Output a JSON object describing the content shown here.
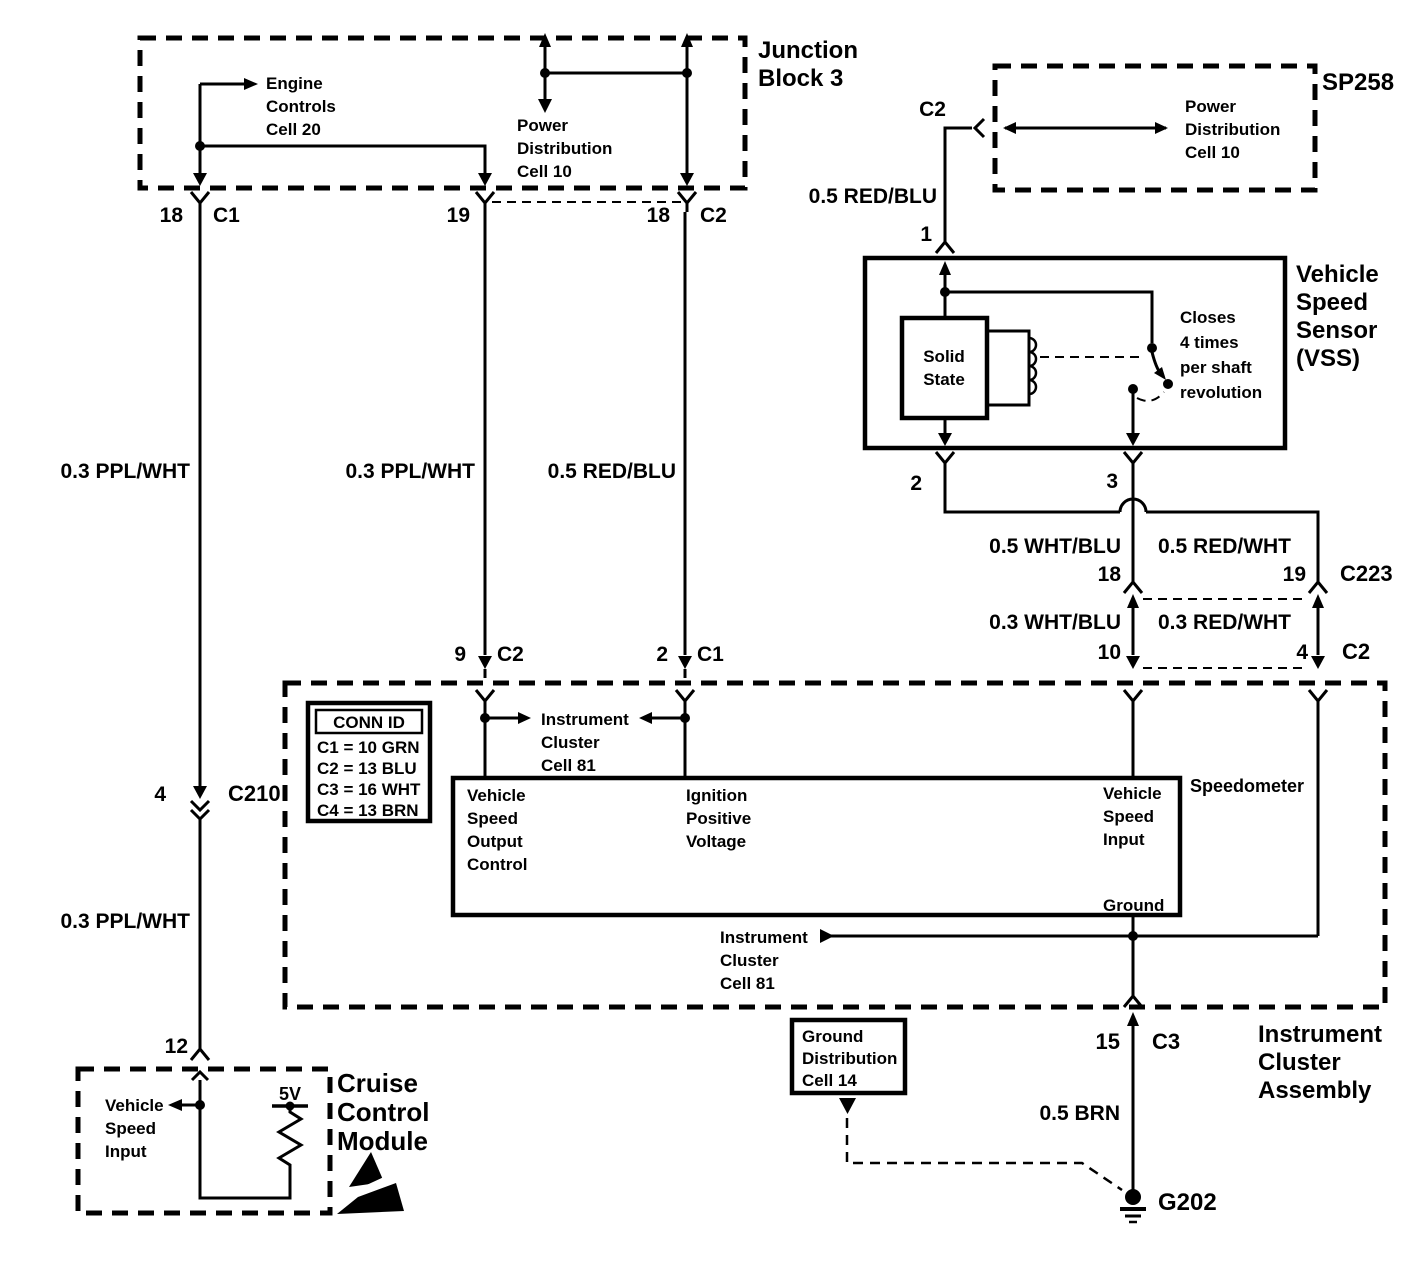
{
  "colors": {
    "ink": "#000000",
    "background": "#ffffff"
  },
  "junction_block": {
    "title": [
      "Junction",
      "Block 3"
    ],
    "engine_controls_ref": [
      "Engine",
      "Controls",
      "Cell 20"
    ],
    "power_distribution_ref": [
      "Power",
      "Distribution",
      "Cell 10"
    ],
    "pin_18_left": "18",
    "conn_c1": "C1",
    "pin_19": "19",
    "pin_18_right": "18",
    "conn_c2": "C2"
  },
  "sp258": {
    "title": "SP258",
    "conn_c2": "C2",
    "power_distribution_ref": [
      "Power",
      "Distribution",
      "Cell 10"
    ],
    "wire_label": "0.5 RED/BLU",
    "pin_1": "1"
  },
  "vss": {
    "title": [
      "Vehicle",
      "Speed",
      "Sensor",
      "(VSS)"
    ],
    "solid_state": [
      "Solid",
      "State"
    ],
    "closes_note": [
      "Closes",
      "4 times",
      "per shaft",
      "revolution"
    ],
    "pin_2": "2",
    "pin_3": "3"
  },
  "right_wires": {
    "wht_blu_05": "0.5 WHT/BLU",
    "red_wht_05": "0.5 RED/WHT",
    "pin_18": "18",
    "pin_19": "19",
    "conn_c223": "C223",
    "wht_blu_03": "0.3 WHT/BLU",
    "red_wht_03": "0.3 RED/WHT",
    "pin_10": "10",
    "pin_4": "4",
    "conn_c2": "C2"
  },
  "left_wires": {
    "ppl_wht_upper": "0.3 PPL/WHT",
    "ppl_wht_mid": "0.3 PPL/WHT",
    "red_blu_mid": "0.5 RED/BLU",
    "pin_4": "4",
    "conn_c210": "C210",
    "ppl_wht_lower": "0.3 PPL/WHT",
    "pin_12": "12",
    "pin_9": "9",
    "conn_c2": "C2",
    "pin_2": "2",
    "conn_c1": "C1"
  },
  "cluster": {
    "title": [
      "Instrument",
      "Cluster",
      "Assembly"
    ],
    "conn_id_table": {
      "header": "CONN ID",
      "rows": [
        "C1 = 10 GRN",
        "C2 = 13 BLU",
        "C3 = 16 WHT",
        "C4 = 13 BRN"
      ]
    },
    "cell81_top_ref": [
      "Instrument",
      "Cluster",
      "Cell 81"
    ],
    "cell81_bottom_ref": [
      "Instrument",
      "Cluster",
      "Cell 81"
    ],
    "speedometer_label": "Speedometer",
    "vehicle_speed_output": [
      "Vehicle",
      "Speed",
      "Output",
      "Control"
    ],
    "ignition_positive": [
      "Ignition",
      "Positive",
      "Voltage"
    ],
    "vehicle_speed_input": [
      "Vehicle",
      "Speed",
      "Input"
    ],
    "ground_label": "Ground",
    "pin_15": "15",
    "conn_c3": "C3"
  },
  "ground_path": {
    "wire_label": "0.5 BRN",
    "g202": "G202",
    "ground_distribution_ref": [
      "Ground",
      "Distribution",
      "Cell 14"
    ]
  },
  "cruise": {
    "title": [
      "Cruise",
      "Control",
      "Module"
    ],
    "vehicle_speed_input": [
      "Vehicle",
      "Speed",
      "Input"
    ],
    "supply": "5V"
  }
}
